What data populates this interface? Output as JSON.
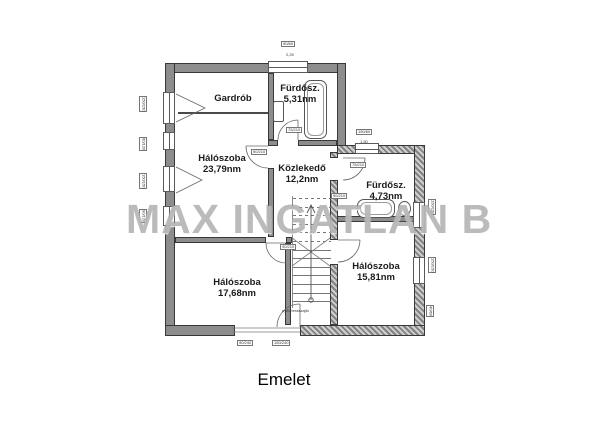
{
  "plan": {
    "caption": "Emelet",
    "watermark": "MAX INGATLAN B",
    "colors": {
      "wall_fill": "#8d8d8d",
      "wall_edge": "#383838",
      "watermark_gray": "#7c7c7c",
      "line": "#666666"
    },
    "rooms": [
      {
        "name": "Gardrób",
        "area": ""
      },
      {
        "name": "Fürdősz.",
        "area": "5,31nm"
      },
      {
        "name": "Hálószoba",
        "area": "23,79nm"
      },
      {
        "name": "Közlekedő",
        "area": "12,2nm"
      },
      {
        "name": "Fürdősz.",
        "area": "4,73nm"
      },
      {
        "name": "Hálószoba",
        "area": "17,68nm"
      },
      {
        "name": "Hálószoba",
        "area": "15,81nm"
      }
    ],
    "dim_labels": [
      {
        "t": "150/150",
        "x": 139,
        "y": 96,
        "v": 1,
        "b": 1
      },
      {
        "t": "60/120",
        "x": 139,
        "y": 137,
        "v": 1,
        "b": 1
      },
      {
        "t": "150/150",
        "x": 139,
        "y": 173,
        "v": 1,
        "b": 1
      },
      {
        "t": "90/120",
        "x": 139,
        "y": 209,
        "v": 1,
        "b": 1
      },
      {
        "t": "90/60",
        "x": 281,
        "y": 41,
        "b": 1
      },
      {
        "t": "2,25",
        "x": 286,
        "y": 53
      },
      {
        "t": "150/60",
        "x": 356,
        "y": 129,
        "b": 1
      },
      {
        "t": "1,50",
        "x": 360,
        "y": 140
      },
      {
        "t": "150/150",
        "x": 428,
        "y": 199,
        "v": 1,
        "b": 1
      },
      {
        "t": "150/150",
        "x": 428,
        "y": 257,
        "v": 1,
        "b": 1
      },
      {
        "t": "40/60",
        "x": 426,
        "y": 305,
        "v": 1,
        "b": 1
      },
      {
        "t": "90/240",
        "x": 237,
        "y": 340,
        "b": 1
      },
      {
        "t": "150/240",
        "x": 272,
        "y": 340,
        "b": 1
      },
      {
        "t": "90/210",
        "x": 251,
        "y": 149,
        "b": 1
      },
      {
        "t": "75/210",
        "x": 286,
        "y": 127,
        "b": 1
      },
      {
        "t": "75/210",
        "x": 350,
        "y": 162,
        "b": 1
      },
      {
        "t": "90/210",
        "x": 331,
        "y": 193,
        "b": 1
      },
      {
        "t": "90/210",
        "x": 280,
        "y": 244,
        "b": 1
      },
      {
        "t": "nyíló teraszajtó",
        "x": 282,
        "y": 309
      }
    ],
    "stairs": {
      "tread_count": 13,
      "dashed_top_count": 6
    }
  }
}
